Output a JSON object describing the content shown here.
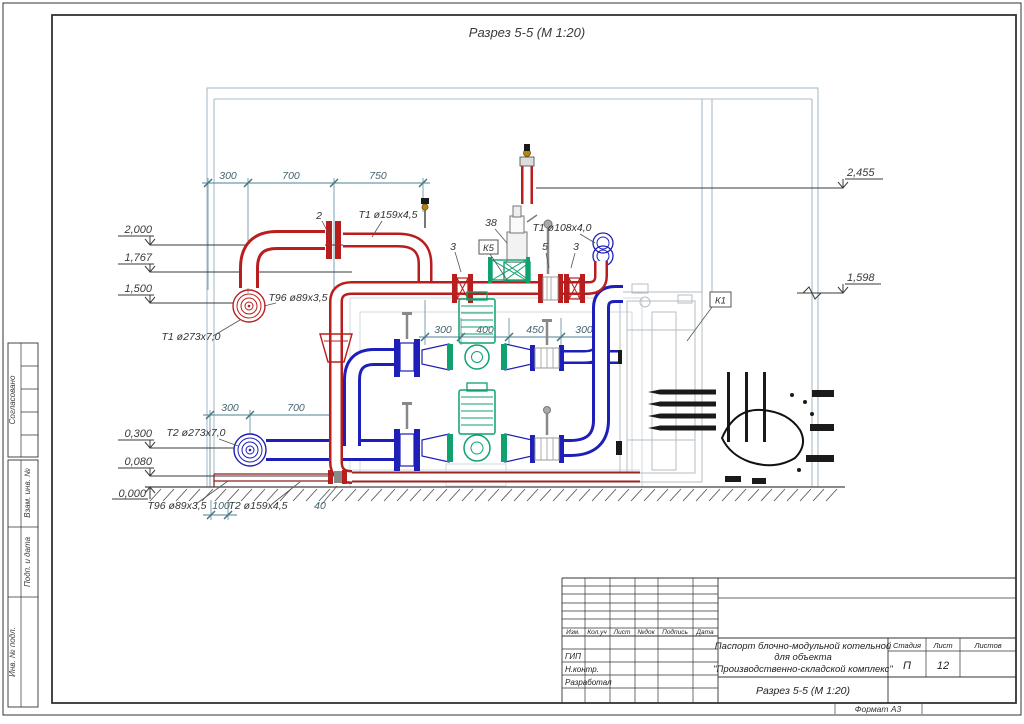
{
  "title": "Разрез 5-5 (М 1:20)",
  "sheet": {
    "format_label": "Формат А3"
  },
  "margin_stamps": {
    "soglasovano": "Согласовано",
    "vzam": "Взам. инв. №",
    "podp": "Подп. и дата",
    "inv": "Инв. № подл."
  },
  "dims": {
    "top": [
      "300",
      "700",
      "750"
    ],
    "mid": [
      "300",
      "400",
      "450",
      "300"
    ],
    "left_lower": [
      "300",
      "700"
    ],
    "bottom_100": "100",
    "bottom_40": "40"
  },
  "elevations": {
    "e2000": "2,000",
    "e1767": "1,767",
    "e1500": "1,500",
    "e0300": "0,300",
    "e0080": "0,080",
    "e0000": "0,000",
    "e2455": "2,455",
    "e1598": "1,598"
  },
  "pipe_labels": {
    "t1_159": "Т1 ø159х4,5",
    "t96_89_top": "Т96 ø89х3,5",
    "t1_273": "Т1 ø273х7,0",
    "t2_273": "Т2 ø273х7,0",
    "t96_89_bottom": "Т96 ø89х3,5",
    "t2_159": "Т2 ø159х4,5",
    "t1_108": "Т1 ø108х4,0"
  },
  "callouts": {
    "c2": "2",
    "c3a": "3",
    "c38": "38",
    "k5": "К5",
    "c5": "5",
    "c3b": "3",
    "k1": "К1"
  },
  "title_block": {
    "header_cols": [
      "Изм.",
      "Кол.уч",
      "Лист",
      "№док",
      "Подпись",
      "Дата"
    ],
    "roles": [
      "ГИП",
      "Н.контр.",
      "Разработал"
    ],
    "doc_title_line1": "Паспорт блочно-модульной котельной",
    "doc_title_line2": "для объекта",
    "doc_title_line3": "\"Производственно-складской комплекс\"",
    "drawing_name": "Разрез 5-5  (М 1:20)",
    "stage_label": "Стадия",
    "sheet_label": "Лист",
    "sheets_label": "Листов",
    "stage_value": "П",
    "sheet_value": "12",
    "sheets_value": ""
  }
}
